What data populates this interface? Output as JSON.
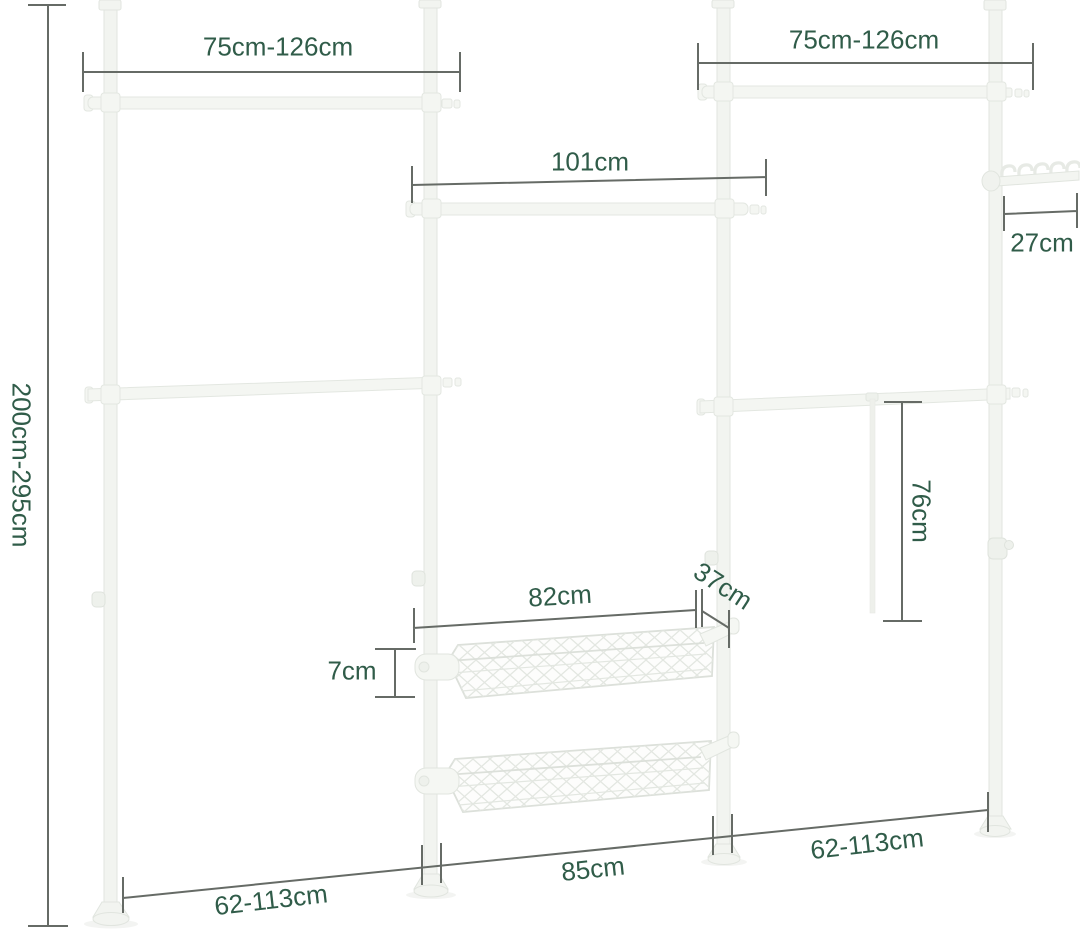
{
  "diagram": {
    "description": "Telescopic wardrobe clothes rack dimension diagram",
    "labels": {
      "top_left_rod_width": "75cm-126cm",
      "top_right_rod_width": "75cm-126cm",
      "middle_rod_width": "101cm",
      "hook_rail_width": "27cm",
      "overall_height_range": "200cm-295cm",
      "hanging_rod_length": "76cm",
      "basket_width": "82cm",
      "basket_depth": "37cm",
      "basket_height": "7cm",
      "bottom_center_span": "85cm",
      "bottom_left_span": "62-113cm",
      "bottom_right_span": "62-113cm"
    },
    "colors": {
      "label_text": "#305c49",
      "dimension_line": "#666b66",
      "structure_fill": "#f3f5f1",
      "structure_stroke": "#e1e5df",
      "background": "#ffffff"
    }
  }
}
